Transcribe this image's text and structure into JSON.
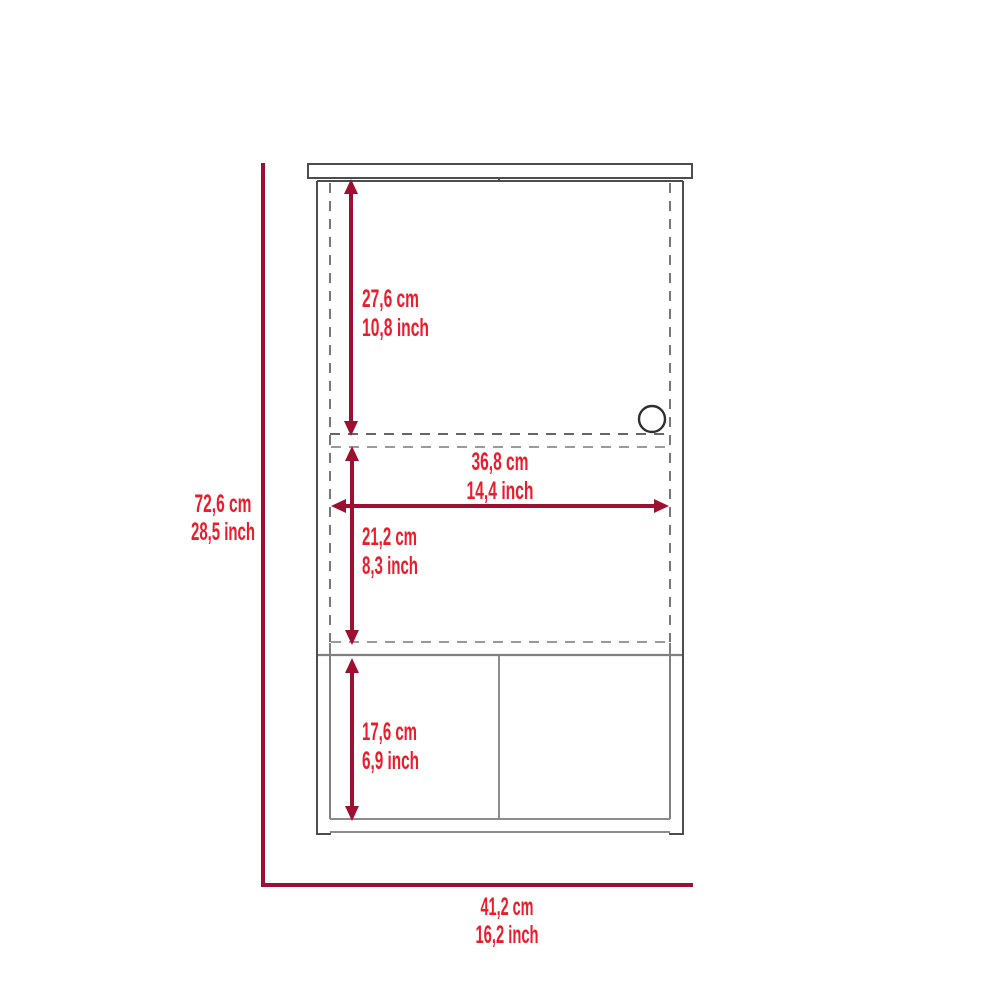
{
  "figure": {
    "kind": "furniture-dimension-diagram",
    "subject": "wall cabinet with door, shelf and open lower compartments, front view"
  },
  "colors": {
    "background": "#ffffff",
    "dimension_line": "#9e1031",
    "label_text": "#ed1c2b",
    "cabinet_outline_dark": "#4d4d4d",
    "cabinet_outline_mid": "#808080",
    "cabinet_outline_light": "#9a9a9a",
    "handle_stroke": "#2f2f2f"
  },
  "dimensions": {
    "overall_height": {
      "cm": "72,6 cm",
      "inch": "28,5 inch"
    },
    "overall_width": {
      "cm": "41,2 cm",
      "inch": "16,2 inch"
    },
    "door_height": {
      "cm": "27,6 cm",
      "inch": "10,8 inch"
    },
    "inner_width": {
      "cm": "36,8 cm",
      "inch": "14,4 inch"
    },
    "middle_section_height": {
      "cm": "21,2 cm",
      "inch": "8,3 inch"
    },
    "bottom_section_height": {
      "cm": "17,6 cm",
      "inch": "6,9 inch"
    }
  }
}
